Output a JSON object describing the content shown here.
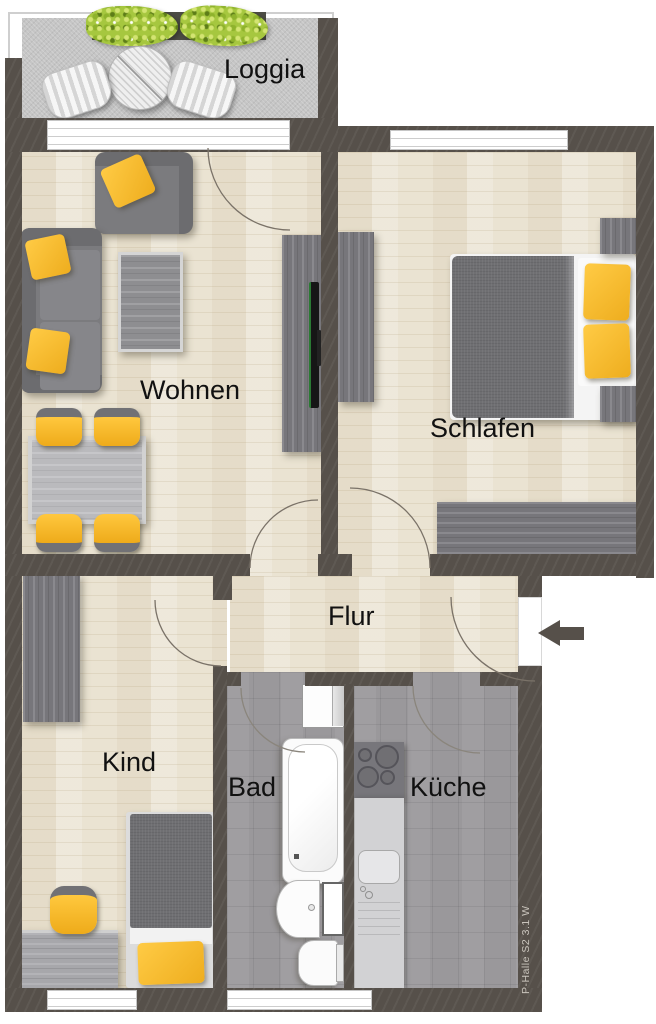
{
  "rooms": {
    "loggia": "Loggia",
    "wohnen": "Wohnen",
    "schlafen": "Schlafen",
    "flur": "Flur",
    "kind": "Kind",
    "bad": "Bad",
    "kueche": "Küche"
  },
  "annotation": "P-Halle S2 3.1 W",
  "entrance": {
    "arrow_direction": "left"
  },
  "colors": {
    "wall": "#56504a",
    "floor_wood": "#eae3d2",
    "floor_tile": "#9a989b",
    "floor_loggia": "#c5c5c5",
    "accent_yellow": "#f3b52d",
    "furniture_gray": "#7b7b7e",
    "plant_green": "#a2c43b",
    "window_white": "#ffffff",
    "label_text": "#111111"
  }
}
